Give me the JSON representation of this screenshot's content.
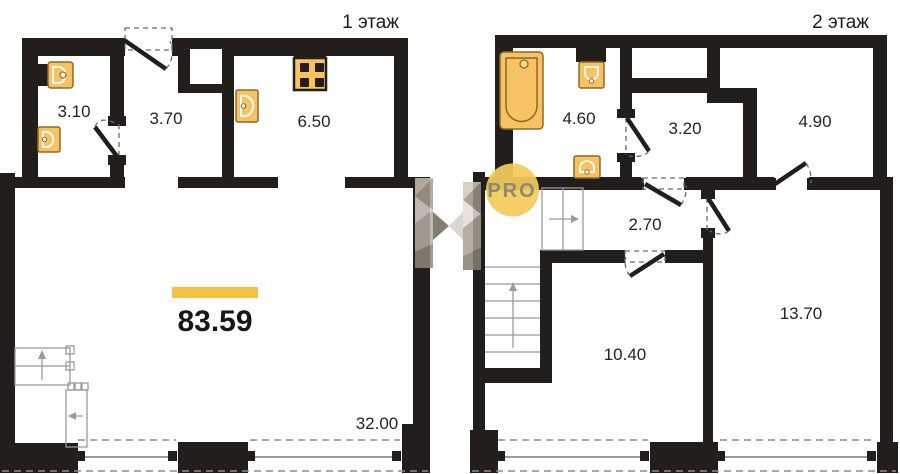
{
  "watermark": {
    "badge": "PRO"
  },
  "colors": {
    "wall": "#211e1c",
    "fixture": "#f7c263",
    "accent_bar": "#f5c242",
    "watermark_circle": "#f2cb59"
  },
  "floor1": {
    "title": "1 этаж",
    "total_area": "83.59",
    "areas": [
      "3.10",
      "3.70",
      "6.50",
      "32.00"
    ]
  },
  "floor2": {
    "title": "2 этаж",
    "areas": [
      "4.60",
      "3.20",
      "4.90",
      "2.70",
      "10.40",
      "13.70"
    ]
  }
}
